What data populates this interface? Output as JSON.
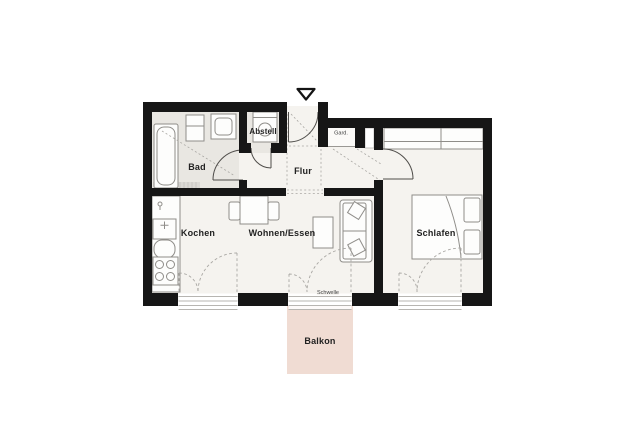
{
  "plan": {
    "labels": {
      "bad": "Bad",
      "abstell": "Abstell",
      "flur": "Flur",
      "garderobe": "Gard.",
      "kochen": "Kochen",
      "wohnen_essen": "Wohnen/Essen",
      "schlafen": "Schlafen",
      "balkon": "Balkon",
      "schwelle": "Schwelle"
    },
    "colors": {
      "wall": "#161616",
      "floor_main": "#f5f3ef",
      "floor_wet": "#e9e7e2",
      "closet_floor": "#fbfaf8",
      "balcony": "#f0dcd3",
      "furniture": "#8f8d89",
      "dash": "#a9a7a3",
      "door": "#4f4d4a",
      "sill": "#b7b5b1",
      "label": "#222222",
      "label_small": "#3d3d3d"
    }
  }
}
